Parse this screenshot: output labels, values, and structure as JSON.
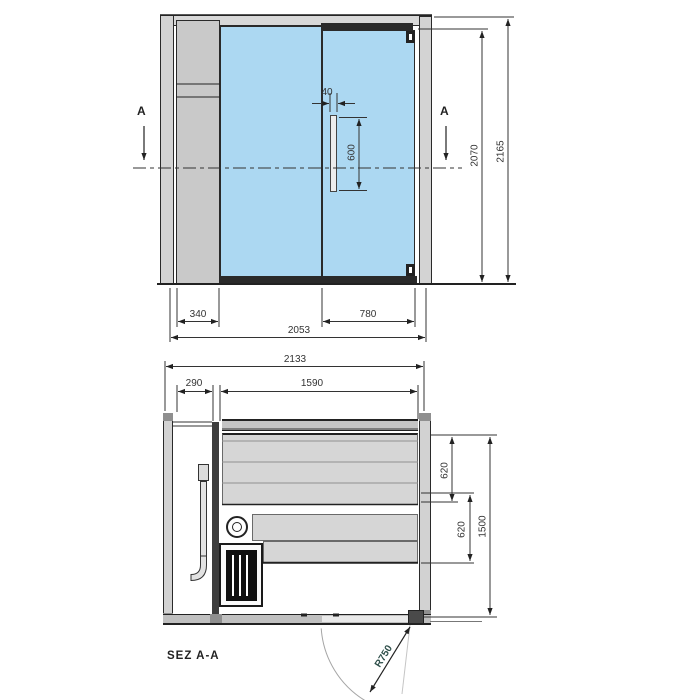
{
  "colors": {
    "glass_blue": "#acd8f2",
    "panel_gray": "#cdcdcd",
    "bench_gray": "#d6d6d6",
    "line_dark": "#222222",
    "dim_text": "#333333",
    "radius_text": "#2e4f4a"
  },
  "elevation": {
    "marker_left": "A",
    "marker_right": "A",
    "dims": {
      "handle_width": "40",
      "handle_length": "600",
      "door_height": "2070",
      "overall_height": "2165",
      "side_panel_width": "340",
      "door_width": "780",
      "front_width": "2053"
    }
  },
  "plan": {
    "dims": {
      "overall_width": "2133",
      "service_gap": "290",
      "interior_width": "1590",
      "bench_upper_depth": "620",
      "bench_lower_depth": "620",
      "interior_depth": "1500",
      "door_swing_radius": "R750"
    },
    "section_label": "SEZ A-A"
  }
}
